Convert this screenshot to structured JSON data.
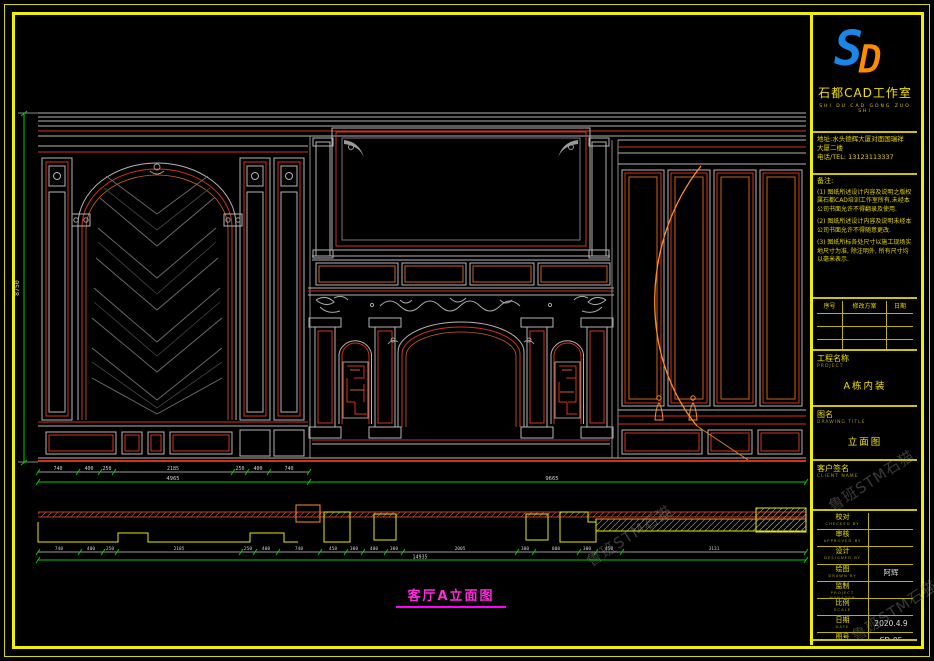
{
  "watermark": {
    "text": "鲁班STM石猫"
  },
  "colors": {
    "border": "#f0f000",
    "line_gray": "#b4b4b4",
    "line_red": "#d43218",
    "line_orange": "#ff8c28",
    "dim_green": "#00cc00",
    "caption": "#ff00ff"
  },
  "title_block": {
    "logo": {
      "s": "S",
      "d": "D"
    },
    "studio_name": "石都CAD工作室",
    "studio_sub": "SHI DU CAD GONG ZUO SHI",
    "address_line1": "地址:水头德辉大厦对面国瑞祥",
    "address_line2": "大厦二楼",
    "tel": "电话/TEL: 13123113337",
    "notes_title": "备注:",
    "notes": [
      "(1) 图纸所述设计内容及说明之版权属石都CAD培训工作室所有,未经本公司书面允许不得翻录及使用.",
      "(2) 图纸所述设计内容及说明未经本公司书面允许不得随意更改.",
      "(3) 图纸所标各处尺寸以施工现场实地尺寸为准, 除注明外, 所有尺寸均以毫米表示."
    ],
    "rev_headers": [
      "序号",
      "修改方案",
      "日期"
    ],
    "project_label": "工程名称",
    "project_label_en": "PROJECT",
    "project_value": "A栋内装",
    "drawing_label": "图名",
    "drawing_label_en": "DRAWING TITLE",
    "drawing_value": "立面图",
    "client_label": "客户签名",
    "client_label_en": "CLIENT NAME",
    "sign_rows": [
      {
        "cn": "校对",
        "en": "CHECKED BY",
        "value": ""
      },
      {
        "cn": "审核",
        "en": "APPROVED BY",
        "value": ""
      },
      {
        "cn": "设计",
        "en": "DESIGNED BY",
        "value": ""
      },
      {
        "cn": "绘图",
        "en": "DRAWN BY",
        "value": "阿辉"
      },
      {
        "cn": "监制",
        "en": "PROJECT MANAGER",
        "value": ""
      },
      {
        "cn": "比例",
        "en": "SCALE",
        "value": ""
      },
      {
        "cn": "日期",
        "en": "DATE",
        "value": "2020.4.9"
      },
      {
        "cn": "图号",
        "en": "DRAWING No.",
        "value": "SD-05"
      }
    ]
  },
  "drawing": {
    "caption": "客厅A立面图",
    "dim_height": "8750",
    "dims_row1": [
      "740",
      "400",
      "250",
      "2185",
      "250",
      "400",
      "740"
    ],
    "total_left": "4965",
    "total_right": "9665",
    "dims_plan": [
      "740",
      "400",
      "250",
      "2185",
      "250",
      "400",
      "740",
      "450",
      "300",
      "400",
      "300",
      "2005",
      "300",
      "800",
      "300",
      "450",
      "3131"
    ],
    "total_plan": "14935"
  }
}
